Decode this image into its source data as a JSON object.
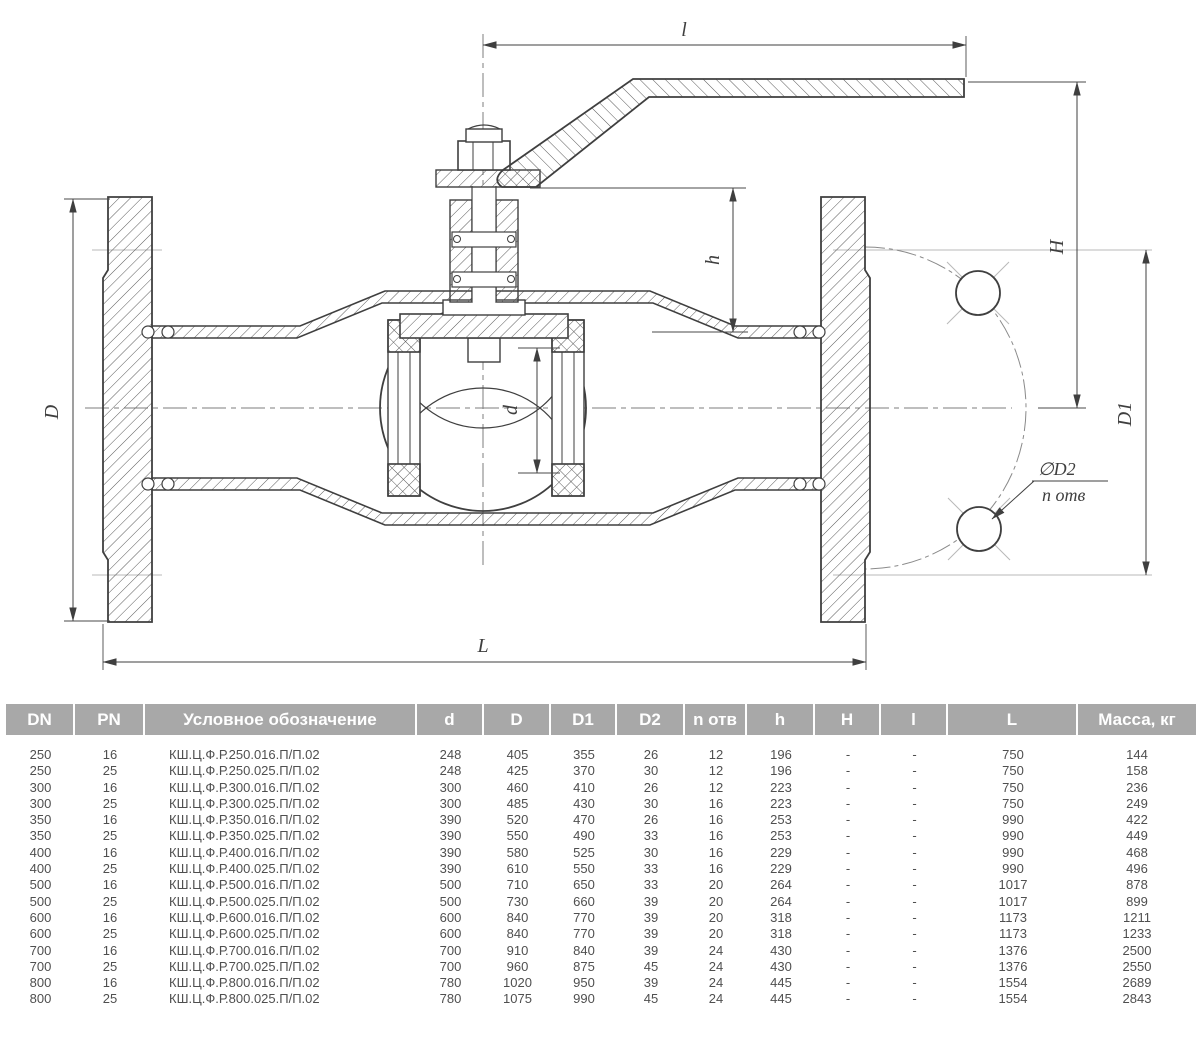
{
  "drawing": {
    "labels": {
      "l": "l",
      "h": "h",
      "H": "H",
      "D": "D",
      "d": "d",
      "D1": "D1",
      "phiD2": "∅D2",
      "n_otv": "n отв",
      "L": "L"
    }
  },
  "table": {
    "headers": [
      "DN",
      "PN",
      "Условное обозначение",
      "d",
      "D",
      "D1",
      "D2",
      "n отв",
      "h",
      "H",
      "l",
      "L",
      "Масса, кг"
    ],
    "rows": [
      [
        "250",
        "16",
        "КШ.Ц.Ф.Р.250.016.П/П.02",
        "248",
        "405",
        "355",
        "26",
        "12",
        "196",
        "-",
        "-",
        "750",
        "144"
      ],
      [
        "250",
        "25",
        "КШ.Ц.Ф.Р.250.025.П/П.02",
        "248",
        "425",
        "370",
        "30",
        "12",
        "196",
        "-",
        "-",
        "750",
        "158"
      ],
      [
        "300",
        "16",
        "КШ.Ц.Ф.Р.300.016.П/П.02",
        "300",
        "460",
        "410",
        "26",
        "12",
        "223",
        "-",
        "-",
        "750",
        "236"
      ],
      [
        "300",
        "25",
        "КШ.Ц.Ф.Р.300.025.П/П.02",
        "300",
        "485",
        "430",
        "30",
        "16",
        "223",
        "-",
        "-",
        "750",
        "249"
      ],
      [
        "350",
        "16",
        "КШ.Ц.Ф.Р.350.016.П/П.02",
        "390",
        "520",
        "470",
        "26",
        "16",
        "253",
        "-",
        "-",
        "990",
        "422"
      ],
      [
        "350",
        "25",
        "КШ.Ц.Ф.Р.350.025.П/П.02",
        "390",
        "550",
        "490",
        "33",
        "16",
        "253",
        "-",
        "-",
        "990",
        "449"
      ],
      [
        "400",
        "16",
        "КШ.Ц.Ф.Р.400.016.П/П.02",
        "390",
        "580",
        "525",
        "30",
        "16",
        "229",
        "-",
        "-",
        "990",
        "468"
      ],
      [
        "400",
        "25",
        "КШ.Ц.Ф.Р.400.025.П/П.02",
        "390",
        "610",
        "550",
        "33",
        "16",
        "229",
        "-",
        "-",
        "990",
        "496"
      ],
      [
        "500",
        "16",
        "КШ.Ц.Ф.Р.500.016.П/П.02",
        "500",
        "710",
        "650",
        "33",
        "20",
        "264",
        "-",
        "-",
        "1017",
        "878"
      ],
      [
        "500",
        "25",
        "КШ.Ц.Ф.Р.500.025.П/П.02",
        "500",
        "730",
        "660",
        "39",
        "20",
        "264",
        "-",
        "-",
        "1017",
        "899"
      ],
      [
        "600",
        "16",
        "КШ.Ц.Ф.Р.600.016.П/П.02",
        "600",
        "840",
        "770",
        "39",
        "20",
        "318",
        "-",
        "-",
        "1173",
        "1211"
      ],
      [
        "600",
        "25",
        "КШ.Ц.Ф.Р.600.025.П/П.02",
        "600",
        "840",
        "770",
        "39",
        "20",
        "318",
        "-",
        "-",
        "1173",
        "1233"
      ],
      [
        "700",
        "16",
        "КШ.Ц.Ф.Р.700.016.П/П.02",
        "700",
        "910",
        "840",
        "39",
        "24",
        "430",
        "-",
        "-",
        "1376",
        "2500"
      ],
      [
        "700",
        "25",
        "КШ.Ц.Ф.Р.700.025.П/П.02",
        "700",
        "960",
        "875",
        "45",
        "24",
        "430",
        "-",
        "-",
        "1376",
        "2550"
      ],
      [
        "800",
        "16",
        "КШ.Ц.Ф.Р.800.016.П/П.02",
        "780",
        "1020",
        "950",
        "39",
        "24",
        "445",
        "-",
        "-",
        "1554",
        "2689"
      ],
      [
        "800",
        "25",
        "КШ.Ц.Ф.Р.800.025.П/П.02",
        "780",
        "1075",
        "990",
        "45",
        "24",
        "445",
        "-",
        "-",
        "1554",
        "2843"
      ]
    ]
  },
  "colors": {
    "line": "#3f3f3f",
    "thin_line": "#4a4a4a",
    "centerline": "#7d7d7d",
    "witness": "#b8b8b8",
    "header_bg": "#a8a8a8",
    "header_text": "#ffffff",
    "body_text": "#4f4f4f"
  }
}
